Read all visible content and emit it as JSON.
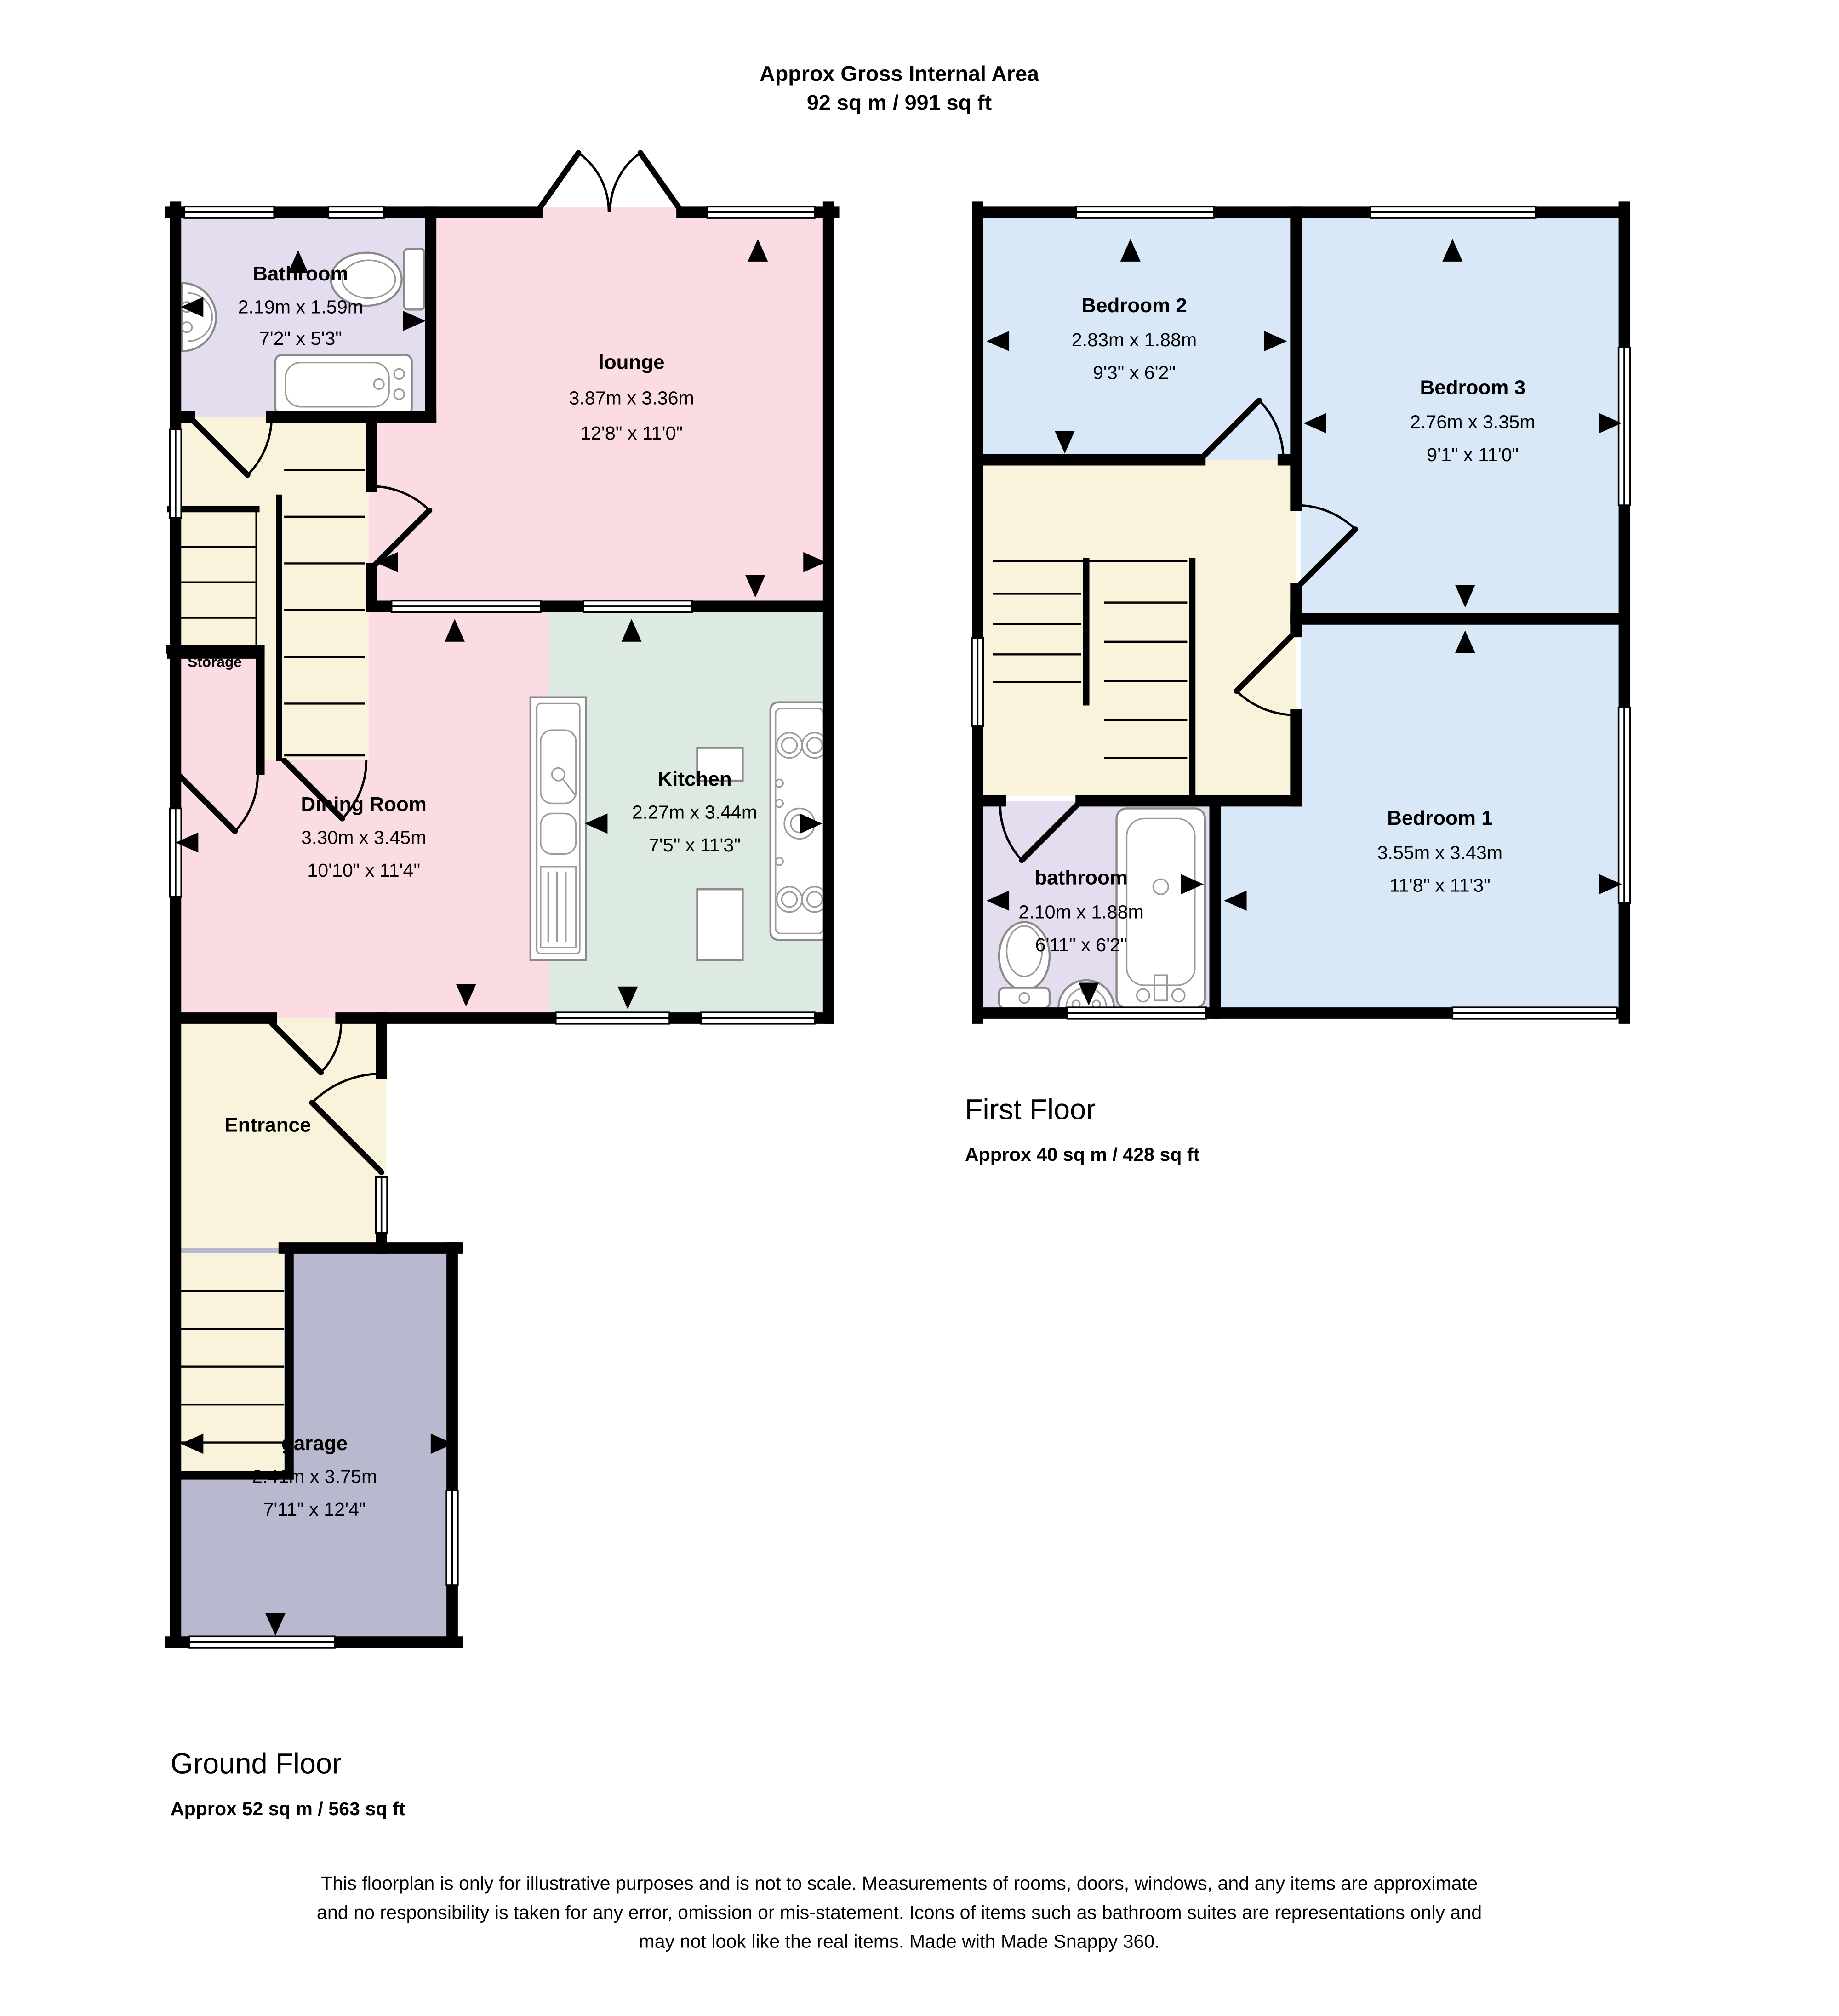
{
  "title": {
    "line1": "Approx Gross Internal Area",
    "line2": "92 sq m / 991 sq ft"
  },
  "ground_floor": {
    "label": "Ground Floor",
    "area": "Approx 52 sq m / 563 sq ft",
    "rooms": {
      "bathroom": {
        "name": "Bathroom",
        "metric": "2.19m x 1.59m",
        "imperial": "7'2\" x 5'3\""
      },
      "lounge": {
        "name": "lounge",
        "metric": "3.87m x 3.36m",
        "imperial": "12'8\" x 11'0\""
      },
      "storage": {
        "name": "Storage"
      },
      "dining": {
        "name": "Dining Room",
        "metric": "3.30m x 3.45m",
        "imperial": "10'10\" x 11'4\""
      },
      "kitchen": {
        "name": "Kitchen",
        "metric": "2.27m x 3.44m",
        "imperial": "7'5\" x 11'3\""
      },
      "entrance": {
        "name": "Entrance"
      },
      "garage": {
        "name": "garage",
        "metric": "2.41m x 3.75m",
        "imperial": "7'11\" x 12'4\""
      }
    }
  },
  "first_floor": {
    "label": "First Floor",
    "area": "Approx 40 sq m / 428 sq ft",
    "rooms": {
      "bedroom2": {
        "name": "Bedroom 2",
        "metric": "2.83m x 1.88m",
        "imperial": "9'3\" x 6'2\""
      },
      "bedroom3": {
        "name": "Bedroom 3",
        "metric": "2.76m x 3.35m",
        "imperial": "9'1\" x 11'0\""
      },
      "bedroom1": {
        "name": "Bedroom 1",
        "metric": "3.55m x 3.43m",
        "imperial": "11'8\" x 11'3\""
      },
      "bathroom": {
        "name": "bathroom",
        "metric": "2.10m x 1.88m",
        "imperial": "6'11\" x 6'2\""
      }
    }
  },
  "footer": {
    "line1": "This floorplan is only for illustrative purposes and is not to scale. Measurements of rooms, doors, windows, and any items are approximate",
    "line2": "and no responsibility is taken for any error, omission or mis-statement. Icons of items such as bathroom suites are representations only and",
    "line3": "may not look like the real items. Made with Made Snappy 360."
  },
  "colors": {
    "pink": "#FADCE2",
    "lavender": "#E4DDEF",
    "cream": "#FAF3DC",
    "mint": "#DCEAE2",
    "blue": "#D8E8F7",
    "gray": "#B8B8CE",
    "wall": "#000000"
  }
}
